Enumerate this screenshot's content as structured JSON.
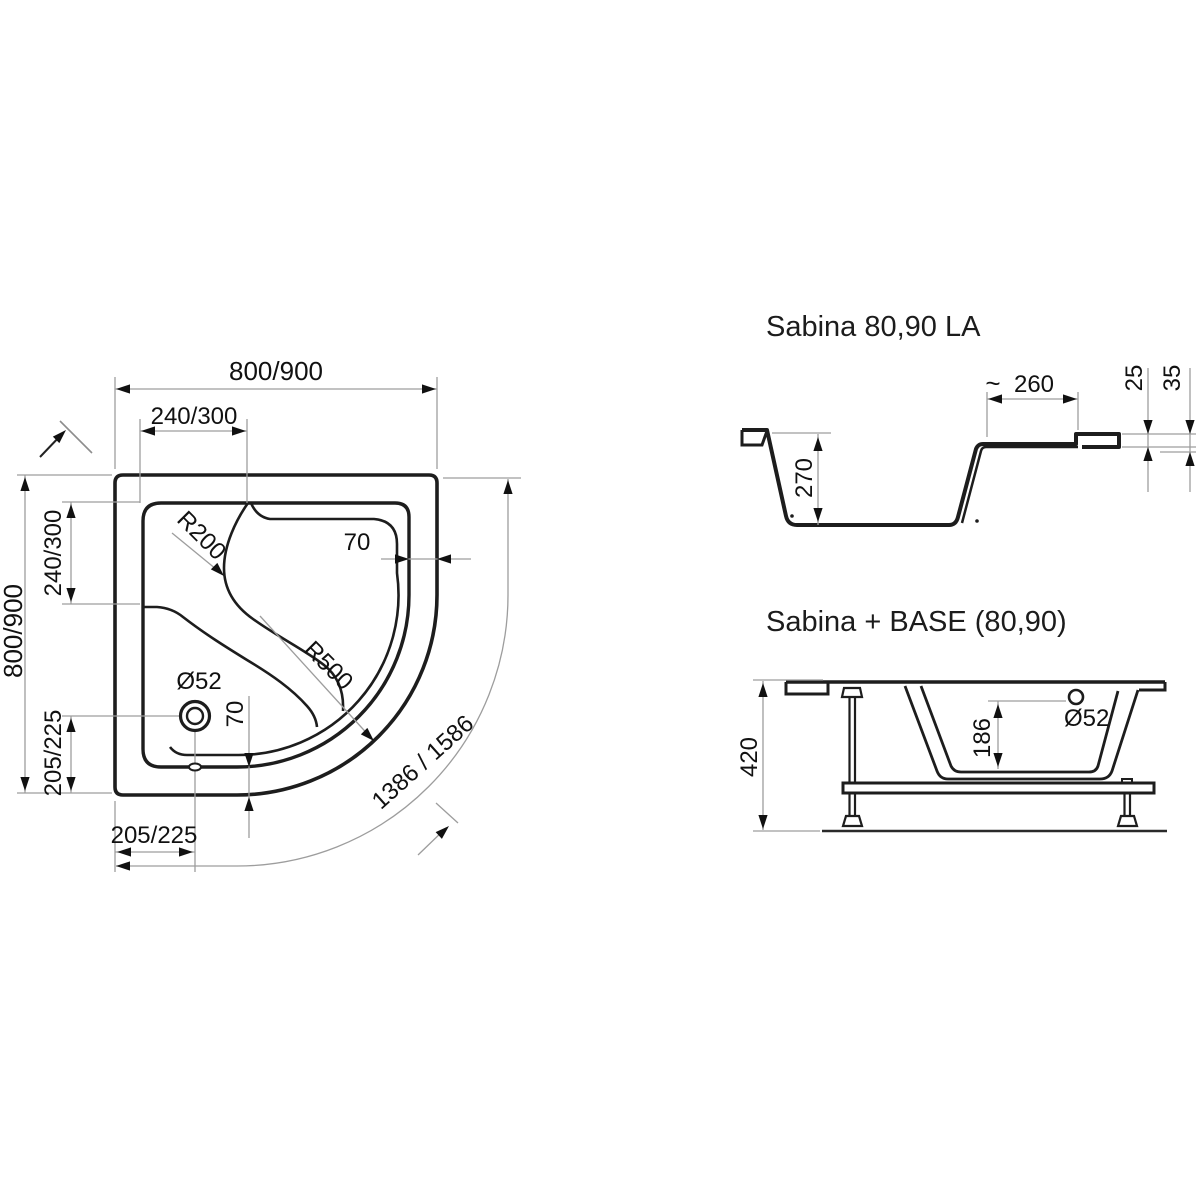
{
  "colors": {
    "line": "#1d1d1d",
    "dim_line": "#9d9d9d",
    "text": "#111111",
    "background": "#ffffff"
  },
  "top_view": {
    "labels": {
      "width_top": "800/900",
      "seat_width_top": "240/300",
      "height_left": "800/900",
      "seat_height_left": "240/300",
      "drain_offset_left": "205/225",
      "drain_offset_bottom": "205/225",
      "rim_width_right": "70",
      "rim_width_bottom": "70",
      "seat_corner_radius": "R200",
      "front_radius": "R500",
      "drain_diameter": "Ø52",
      "arc_length": "1386 / 1586"
    }
  },
  "profile_view": {
    "title": "Sabina 80,90 LA",
    "labels": {
      "approx_sign": "~",
      "ledge_width": "260",
      "lip_height": "25",
      "edge_height": "35",
      "depth": "270"
    }
  },
  "base_view": {
    "title": "Sabina  + BASE (80,90)",
    "labels": {
      "total_height": "420",
      "drain_diameter": "Ø52",
      "inner_depth": "186"
    }
  }
}
